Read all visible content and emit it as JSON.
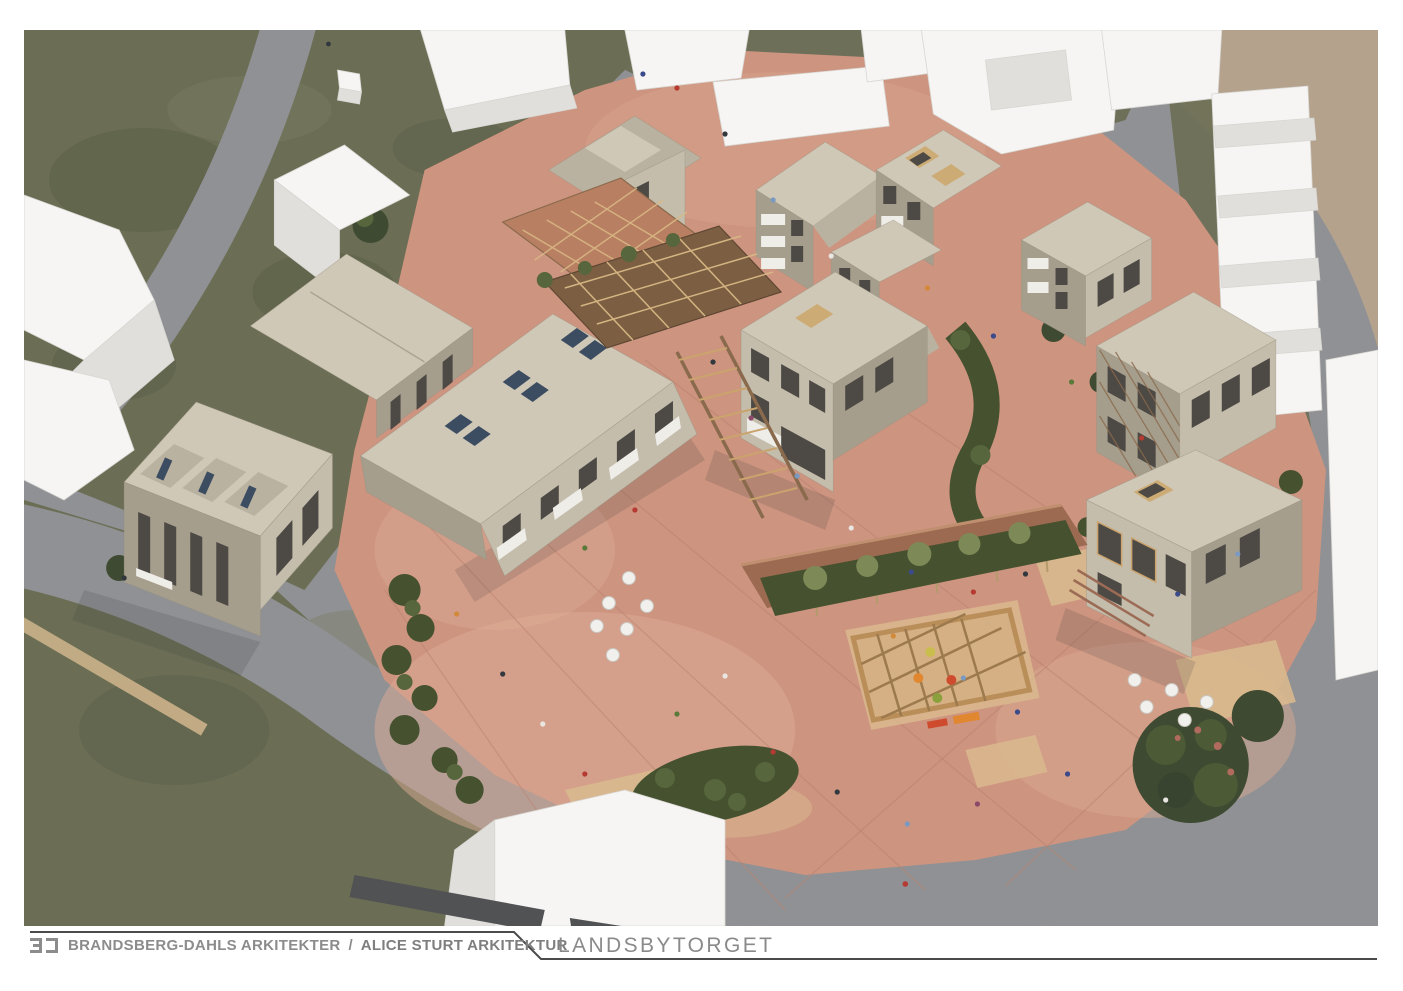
{
  "page": {
    "background": "#ffffff"
  },
  "footer": {
    "firm_primary": "BRANDSBERG-DAHLS ARKITEKTER",
    "separator": "/",
    "firm_secondary": "ALICE STURT ARKITEKTUR",
    "project_title": "LANDSBYTORGET"
  },
  "palette": {
    "grass": "#6b6e54",
    "road": "#8f9194",
    "plaza": "#cd9480",
    "plaza_light": "#ddac95",
    "plaza_patch_tan": "#d9b98e",
    "facade": "#c4bdac",
    "facade_shadow": "#a69e8d",
    "roof": "#cfc8b7",
    "window": "#4d4944",
    "skylight": "#3d4d61",
    "context_white": "#f6f5f3",
    "tree_dark": "#3e4a31",
    "hedge": "#46522f",
    "timber": "#c9a369",
    "canopy": "#9c6a50",
    "bare_ground": "#b4a28d",
    "footer_text": "#8c8c8c",
    "footer_line": "#4a4a4a"
  },
  "scene": {
    "description": "Aerial rendering of the Landsbytorget village-square housing development: beige pitched-roof apartment houses around a salmon paved plaza with timber trellises, a long event canopy, a playground lattice, planting beds, cafe tables and people; white context buildings, olive green lawns and grey ring roads surround the site.",
    "elements": [
      "grass-areas",
      "ring-road",
      "plaza",
      "housing-buildings",
      "context-buildings",
      "conservatory-roof",
      "trellis-canopy",
      "pergola-walkway",
      "event-canopy",
      "playground-structure",
      "planting-beds",
      "trees",
      "cafe-tables",
      "people-figures"
    ]
  }
}
